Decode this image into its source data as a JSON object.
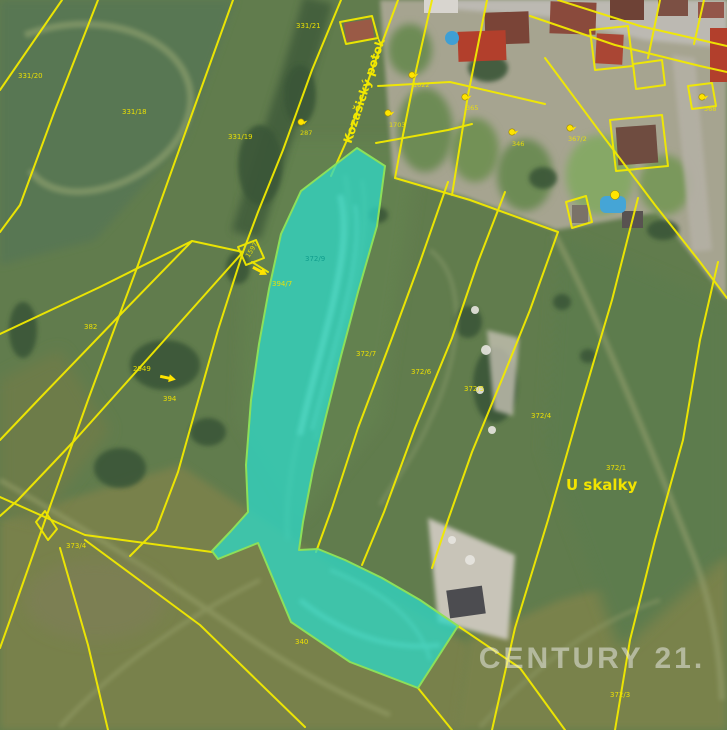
{
  "map": {
    "watermark": "CENTURY 21.",
    "place_label": "U skalky",
    "stream_label": "Kozašický potok",
    "highlight_parcel": "372/9",
    "colors": {
      "parcel_line": "#f2ea00",
      "highlight_fill": "#2fd6c4",
      "highlight_stroke": "#8ce05a",
      "label": "#f0e400",
      "watermark": "rgba(240,240,240,0.5)"
    },
    "labels": [
      {
        "text": "331/20",
        "x": 18,
        "y": 78,
        "variant": "parcel"
      },
      {
        "text": "331/18",
        "x": 122,
        "y": 114,
        "variant": "parcel"
      },
      {
        "text": "331/19",
        "x": 228,
        "y": 139,
        "variant": "parcel"
      },
      {
        "text": "331/21",
        "x": 296,
        "y": 28,
        "variant": "parcel"
      },
      {
        "text": "382",
        "x": 84,
        "y": 329,
        "variant": "parcel"
      },
      {
        "text": "2949",
        "x": 133,
        "y": 371,
        "variant": "parcel"
      },
      {
        "text": "394",
        "x": 163,
        "y": 401,
        "variant": "parcel"
      },
      {
        "text": "373/4",
        "x": 66,
        "y": 548,
        "variant": "parcel"
      },
      {
        "text": "340",
        "x": 295,
        "y": 644,
        "variant": "parcel"
      },
      {
        "text": "372/3",
        "x": 610,
        "y": 697,
        "variant": "parcel"
      },
      {
        "text": "372/7",
        "x": 356,
        "y": 356,
        "variant": "parcel"
      },
      {
        "text": "372/6",
        "x": 411,
        "y": 374,
        "variant": "parcel"
      },
      {
        "text": "372/5",
        "x": 464,
        "y": 391,
        "variant": "parcel"
      },
      {
        "text": "372/4",
        "x": 531,
        "y": 418,
        "variant": "parcel"
      },
      {
        "text": "372/1",
        "x": 606,
        "y": 470,
        "variant": "parcel"
      },
      {
        "text": "394/7",
        "x": 272,
        "y": 286,
        "variant": "parcel"
      },
      {
        "text": "372/9",
        "x": 305,
        "y": 261,
        "variant": "highlight"
      },
      {
        "text": "1597",
        "x": 249,
        "y": 258,
        "variant": "building",
        "rot": -58
      },
      {
        "text": "287",
        "x": 300,
        "y": 135,
        "variant": "building"
      },
      {
        "text": "1022",
        "x": 413,
        "y": 87,
        "variant": "building"
      },
      {
        "text": "365",
        "x": 466,
        "y": 110,
        "variant": "building"
      },
      {
        "text": "1703",
        "x": 389,
        "y": 127,
        "variant": "building"
      },
      {
        "text": "346",
        "x": 512,
        "y": 146,
        "variant": "building"
      },
      {
        "text": "367/2",
        "x": 568,
        "y": 141,
        "variant": "building"
      },
      {
        "text": "368",
        "x": 704,
        "y": 111,
        "variant": "building"
      }
    ],
    "building_markers": [
      {
        "x": 301,
        "y": 122,
        "variant": "chick"
      },
      {
        "x": 412,
        "y": 75,
        "variant": "chick"
      },
      {
        "x": 465,
        "y": 97,
        "variant": "chick"
      },
      {
        "x": 388,
        "y": 113,
        "variant": "chick"
      },
      {
        "x": 570,
        "y": 128,
        "variant": "chick"
      },
      {
        "x": 512,
        "y": 132,
        "variant": "chick"
      },
      {
        "x": 702,
        "y": 97,
        "variant": "chick"
      },
      {
        "x": 615,
        "y": 195,
        "variant": "dot"
      }
    ],
    "arrows": [
      {
        "x": 168,
        "y": 378,
        "angle": 12
      },
      {
        "x": 260,
        "y": 271,
        "angle": 28
      }
    ]
  }
}
